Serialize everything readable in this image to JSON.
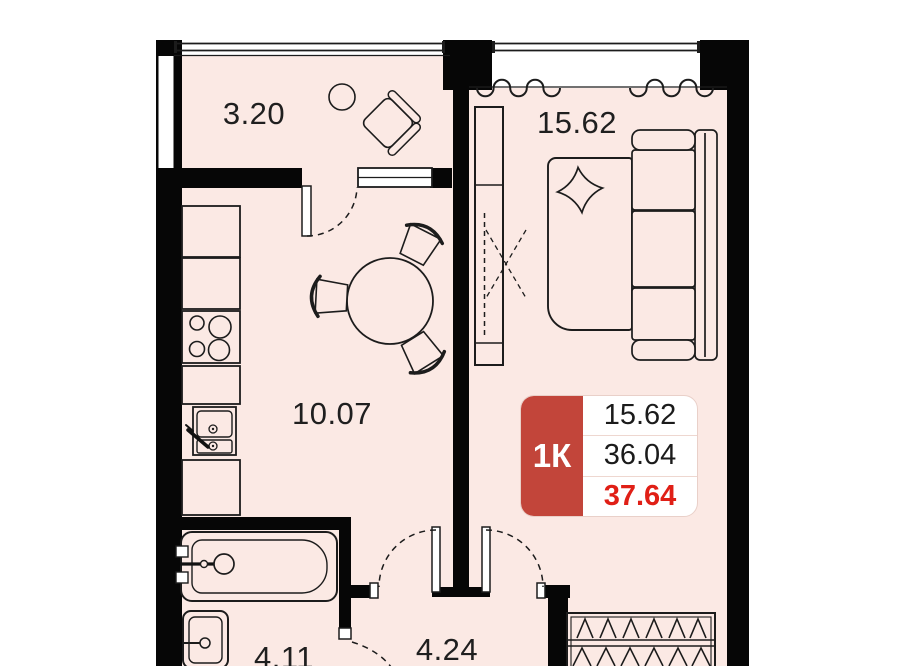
{
  "plan": {
    "title": "1K apartment floor plan",
    "rooms": [
      {
        "id": "balcony",
        "area": "3.20"
      },
      {
        "id": "living",
        "area": "15.62"
      },
      {
        "id": "kitchen",
        "area": "10.07"
      },
      {
        "id": "bathroom",
        "area": "4.11"
      },
      {
        "id": "hallway",
        "area": "4.24"
      }
    ],
    "badge": {
      "type": "1К",
      "living_area": "15.62",
      "area_no_balcony": "36.04",
      "total_area": "37.64"
    },
    "colors": {
      "floor": "#fbe9e4",
      "wall": "#060606",
      "accent_red": "#c2453a",
      "highlight_red": "#e01f16",
      "line": "#1c1c1c"
    }
  }
}
